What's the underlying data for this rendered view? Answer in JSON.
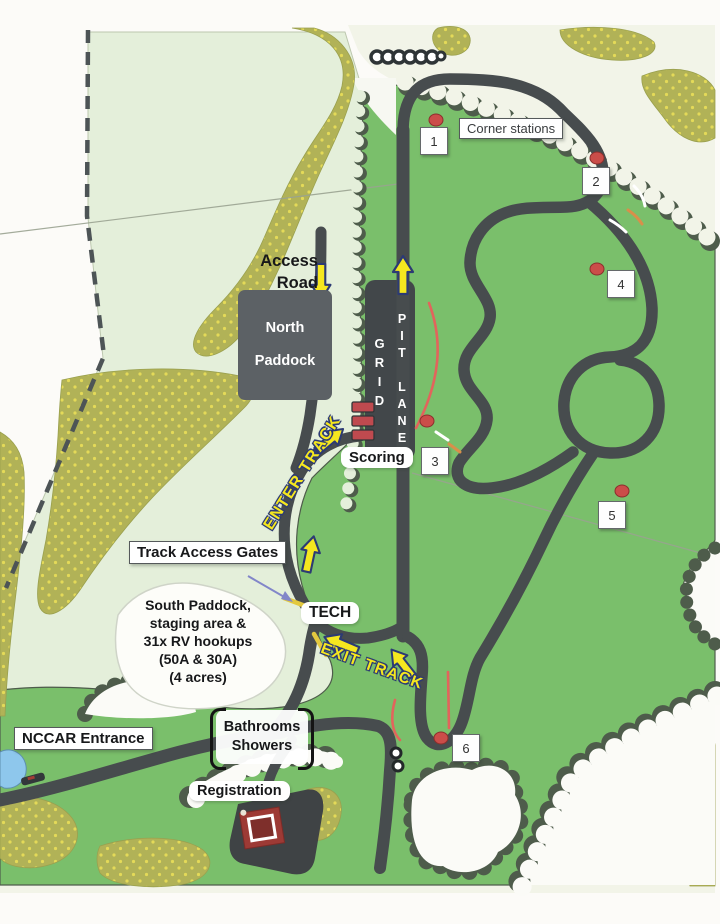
{
  "title": "NCCAR facility and track map",
  "labels": {
    "access_road": "Access Road",
    "north_paddock": "North Paddock",
    "grid": "GRID",
    "pit_lane": "PIT LANE",
    "scoring": "Scoring",
    "enter_track": "ENTER TRACK",
    "exit_track": "EXIT TRACK",
    "track_access_gates": "Track Access Gates",
    "tech": "TECH",
    "south_paddock": "South Paddock,\nstaging area &\n31x RV hookups\n(50A & 30A)\n(4 acres)",
    "nccar_entrance": "NCCAR Entrance",
    "bathrooms_showers": "Bathrooms\nShowers",
    "registration": "Registration",
    "corner_stations_legend": "Corner stations"
  },
  "corner_stations": [
    {
      "number": "1",
      "x": 434,
      "y": 141,
      "dot_x": 436,
      "dot_y": 120
    },
    {
      "number": "2",
      "x": 596,
      "y": 181,
      "dot_x": 597,
      "dot_y": 158
    },
    {
      "number": "3",
      "x": 435,
      "y": 461,
      "dot_x": 427,
      "dot_y": 421
    },
    {
      "number": "4",
      "x": 621,
      "y": 284,
      "dot_x": 597,
      "dot_y": 269
    },
    {
      "number": "5",
      "x": 612,
      "y": 515,
      "dot_x": 622,
      "dot_y": 491
    },
    {
      "number": "6",
      "x": 466,
      "y": 748,
      "dot_x": 441,
      "dot_y": 738
    }
  ],
  "icons": {
    "direction_arrow": "yellow-outlined-arrow",
    "corner_dot": "marshal-station-dot",
    "gate_tick": "yellow-gate-line"
  },
  "colors": {
    "grass_green": "#7abf6b",
    "cleared_green": "#e4efda",
    "scrub_olive": "#b1b257",
    "track_gray": "#474c4e",
    "arrow_yellow": "#f5e71f",
    "arrow_outline_navy": "#2c3a74",
    "marker_red": "#cb4d49",
    "pond_blue": "#8ec7ec"
  }
}
